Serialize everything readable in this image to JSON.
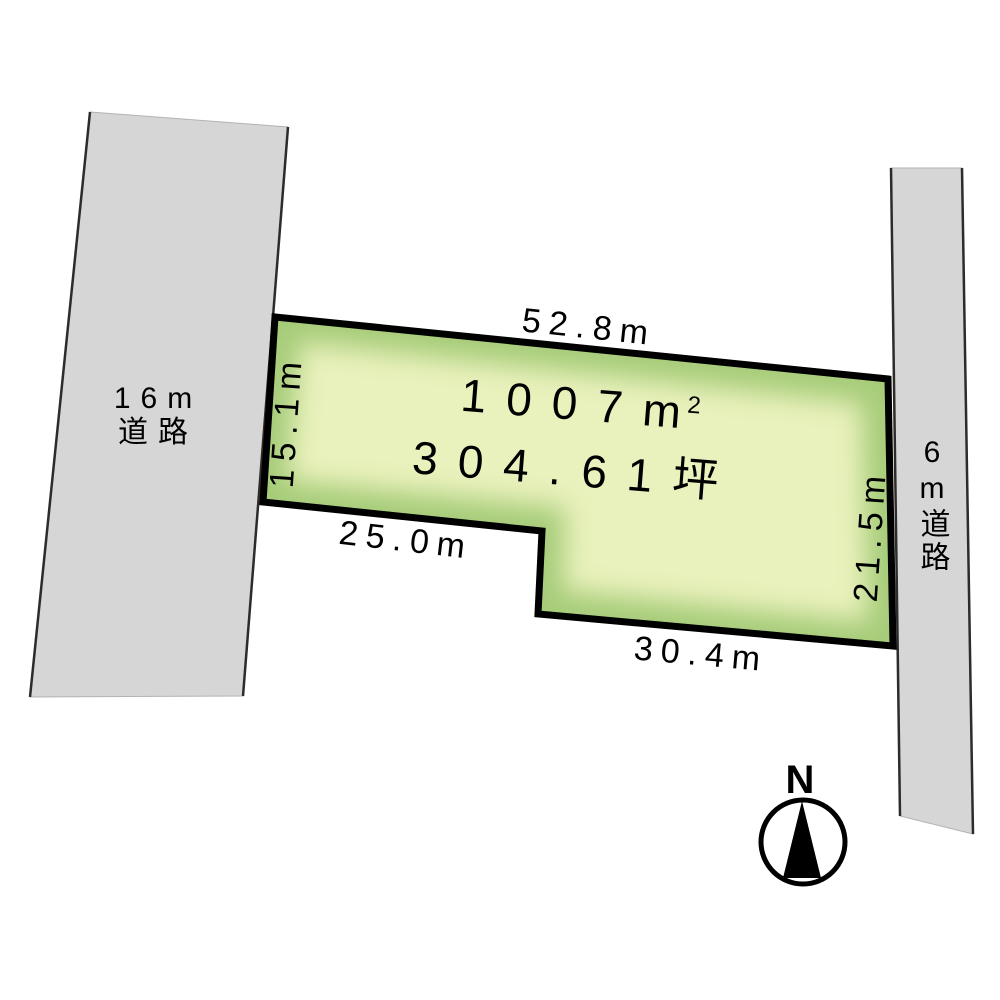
{
  "diagram": {
    "plot": {
      "area_m2_main": "1007m",
      "area_m2_sup": "2",
      "area_tsubo": "304.61坪",
      "dim_top": "52.8m",
      "dim_left": "15.1m",
      "dim_right": "21.5m",
      "dim_bottom_left": "25.0m",
      "dim_bottom_right": "30.4m",
      "fill_edge": "#a6cc79",
      "fill_center": "#e9f1bc",
      "border_color": "#000000"
    },
    "roads": {
      "fill": "#d6d6d6",
      "edge_color": "#2f2b28",
      "left_label_line1": "16m",
      "left_label_line2": "道路",
      "right_label": "6m道路"
    },
    "compass": {
      "north": "N"
    }
  }
}
